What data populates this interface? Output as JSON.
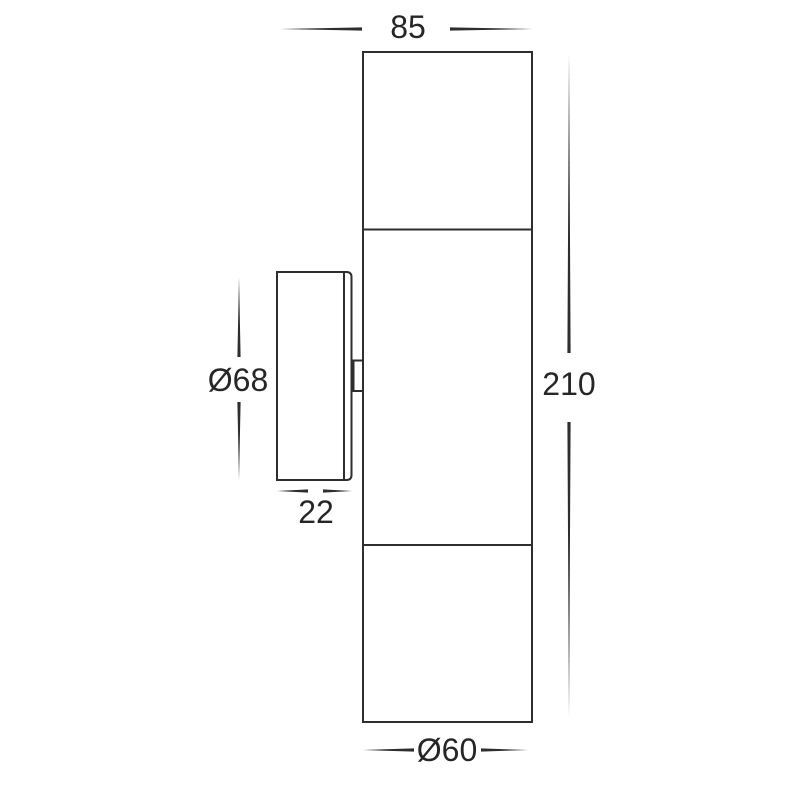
{
  "drawing": {
    "line_color": "#2e2e2e",
    "text_color": "#262626",
    "dimensions": {
      "body_width": "85",
      "body_height": "210",
      "plate_diameter": "Ø68",
      "plate_depth": "22",
      "tube_diameter": "Ø60"
    }
  }
}
